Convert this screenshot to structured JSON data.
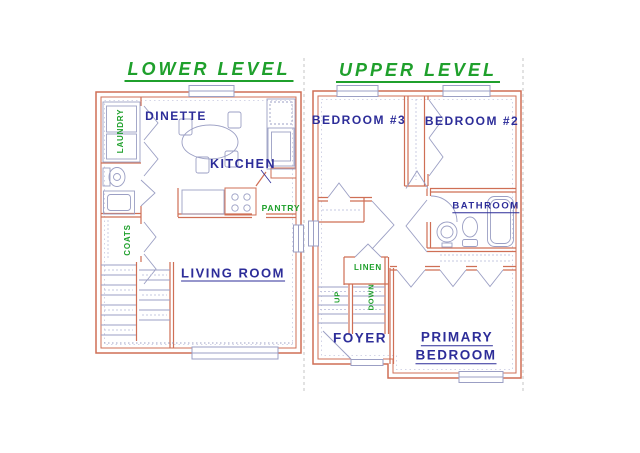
{
  "colors": {
    "wall": "#cf6f55",
    "fixture": "#9b9fc4",
    "fixture_light": "#c6c8e0",
    "blue": "#2d2d99",
    "green": "#1fa02c",
    "separator": "#c6c6c6",
    "bg": "#ffffff"
  },
  "lower_level": {
    "title": "LOWER LEVEL",
    "labels": {
      "dinette": "DINETTE",
      "kitchen": "KITCHEN",
      "pantry": "PANTRY",
      "laundry": "LAUNDRY",
      "coats": "COATS",
      "living_room": "LIVING ROOM"
    }
  },
  "upper_level": {
    "title": "UPPER LEVEL",
    "labels": {
      "bedroom3": "BEDROOM #3",
      "bedroom2": "BEDROOM #2",
      "bathroom": "BATHROOM",
      "linen": "LINEN",
      "up": "UP",
      "down": "DOWN",
      "foyer": "FOYER",
      "primary_line1": "PRIMARY",
      "primary_line2": "BEDROOM"
    }
  }
}
